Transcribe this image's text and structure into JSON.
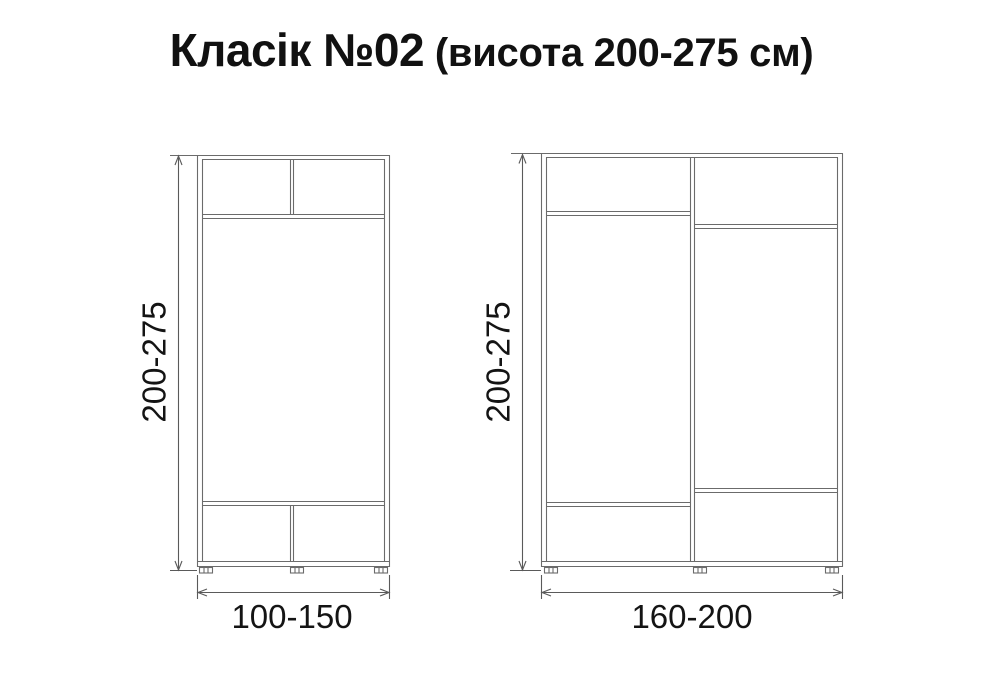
{
  "title": {
    "main": "Класік №02",
    "sub": " (висота 200-275 см)"
  },
  "left_diagram": {
    "height_label": "200-275",
    "width_label": "100-150"
  },
  "right_diagram": {
    "height_label": "200-275",
    "width_label": "160-200"
  },
  "colors": {
    "line": "#6b6b6b",
    "dimension_line": "#5a5a5a",
    "text": "#141414",
    "background": "#ffffff"
  }
}
